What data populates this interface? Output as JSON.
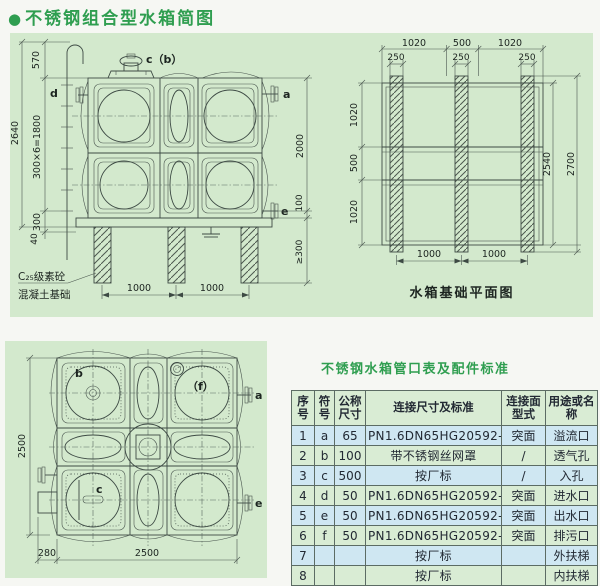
{
  "title": {
    "bullet": "●",
    "text": "不锈钢组合型水箱简图"
  },
  "colors": {
    "accent_green": "#2f9e50",
    "panel_green": "#d3e9cd",
    "row_blue": "#cfe7f2",
    "row_green": "#d9ecd4",
    "line_dark": "#3d4a44"
  },
  "elevation": {
    "label_cb": "c（b）",
    "label_d": "d",
    "label_a": "a",
    "label_e": "e",
    "dim_570": "570",
    "dim_2640": "2640",
    "dim_ladder": "300×6=1800",
    "dim_300": "300",
    "dim_40": "40",
    "dim_2000": "2000",
    "dim_100": "100",
    "dim_ge300": "≥300",
    "dim_1000a": "1000",
    "dim_1000b": "1000",
    "note_line1": "C₂₅级素砼",
    "note_line2": "混凝土基础"
  },
  "foundation_plan": {
    "title": "水箱基础平面图",
    "dim_top": [
      "1020",
      "500",
      "1020"
    ],
    "dim_pads": [
      "250",
      "250",
      "250"
    ],
    "dim_left": [
      "1020",
      "500",
      "1020"
    ],
    "dim_2540": "2540",
    "dim_2700": "2700",
    "dim_bottom": [
      "1000",
      "1000"
    ]
  },
  "plan_view": {
    "label_b": "b",
    "label_f": "（f）",
    "label_a": "a",
    "label_c": "c",
    "label_e": "e",
    "dim_2500_left": "2500",
    "dim_280": "280",
    "dim_2500_bottom": "2500"
  },
  "pipe_table": {
    "title": "不锈钢水箱管口表及配件标准",
    "headers": [
      "序号",
      "符号",
      "公称尺寸",
      "连接尺寸及标准",
      "连接面型式",
      "用途或名称"
    ],
    "rows": [
      [
        "1",
        "a",
        "65",
        "PN1.6DN65HG20592-97",
        "突面",
        "溢流口"
      ],
      [
        "2",
        "b",
        "100",
        "带不锈钢丝网罩",
        "/",
        "透气孔"
      ],
      [
        "3",
        "c",
        "500",
        "按厂标",
        "/",
        "入孔"
      ],
      [
        "4",
        "d",
        "50",
        "PN1.6DN65HG20592-97",
        "突面",
        "进水口"
      ],
      [
        "5",
        "e",
        "50",
        "PN1.6DN65HG20592-97",
        "突面",
        "出水口"
      ],
      [
        "6",
        "f",
        "50",
        "PN1.6DN65HG20592-97",
        "突面",
        "排污口"
      ],
      [
        "7",
        "",
        "",
        "按厂标",
        "",
        "外扶梯"
      ],
      [
        "8",
        "",
        "",
        "按厂标",
        "",
        "内扶梯"
      ]
    ]
  }
}
